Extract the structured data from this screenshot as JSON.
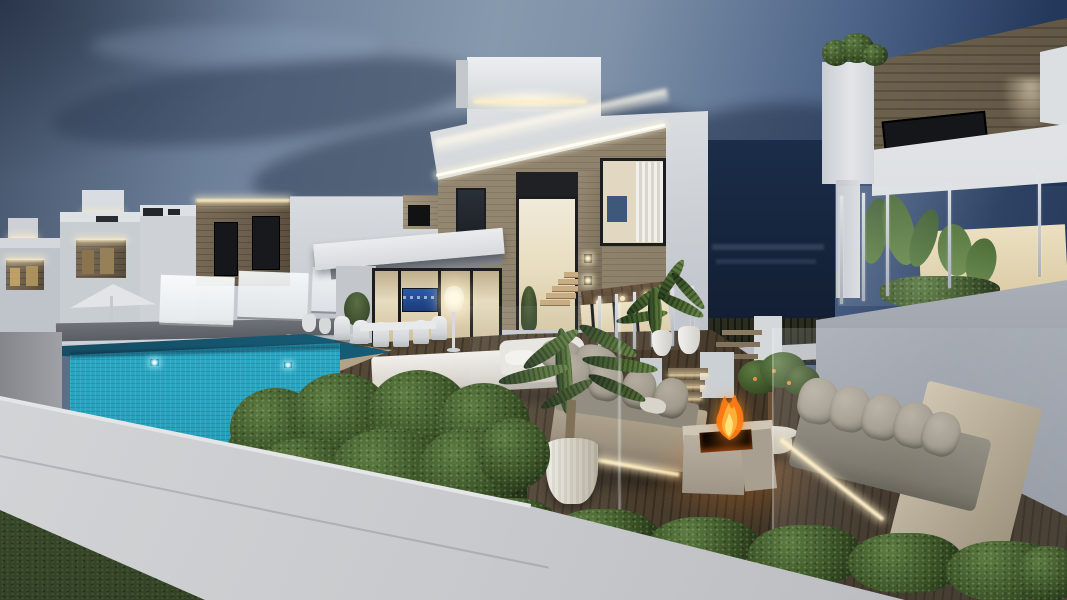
{
  "meta": {
    "title": "Modern luxury villas with glass-walled infinity pool at dusk — 3D architectural rendering",
    "type": "architectural visualization",
    "time_of_day": "dusk"
  },
  "scene": {
    "description": "Two-storey white modern villas with stone accent cladding and warm cove LED lighting, a glass-walled turquoise mosaic infinity pool, wooden deck terraces with grey outdoor lounge sofas, a burning square stone fire pit, potted palms, trimmed box hedges, frosted and clear glass balustrades, white boundary walls and a dark mountain backdrop under a blue evening sky.",
    "elements": [
      {
        "name": "sky",
        "desc": "dusk gradient sky with dark blue cloud streaks"
      },
      {
        "name": "background-villas",
        "desc": "row of white villas receding to the left with LED strips under parapets and warm lit stone recesses"
      },
      {
        "name": "main-villa",
        "desc": "two-storey white villa with stone band, tall staircase window, lit warm interiors and roof parapet with LED"
      },
      {
        "name": "right-villa",
        "desc": "villa with horizontal wood cladding band, downlight, glass balcony with banana plants"
      },
      {
        "name": "mountain",
        "desc": "dark hillside with faint distant buildings in the gap between villas"
      },
      {
        "name": "infinity-pool",
        "desc": "glass-walled pool with bright turquoise mosaic tile face and underwater lights"
      },
      {
        "name": "daybed",
        "desc": "white double sun lounger with grey back cushions at pool edge"
      },
      {
        "name": "dining-set",
        "desc": "white outdoor dining chairs and table on covered terrace"
      },
      {
        "name": "floor-lamp",
        "desc": "glowing white cone floor lamp"
      },
      {
        "name": "parasol",
        "desc": "white patio umbrella on left terrace"
      },
      {
        "name": "left-sofa",
        "desc": "outdoor sofa with grey cushions and warm LED underlighting"
      },
      {
        "name": "right-sofa",
        "desc": "long outdoor sofa seen through a glass screen"
      },
      {
        "name": "fire-pit",
        "desc": "square light stone fire pit with burning flames"
      },
      {
        "name": "side-table",
        "desc": "round white table with a small orange tree"
      },
      {
        "name": "palm-pot",
        "desc": "large potted palm on the lower deck"
      },
      {
        "name": "terrace-palms",
        "desc": "two potted palms on the upper terrace"
      },
      {
        "name": "hedge-front",
        "desc": "large trimmed hedge mass beside the pool"
      },
      {
        "name": "hedge-row",
        "desc": "low hedge row running along the lower boundary wall"
      },
      {
        "name": "foreground-wall",
        "desc": "white rendered boundary wall in the foreground"
      },
      {
        "name": "grass",
        "desc": "dark lawn in the bottom-left corner"
      },
      {
        "name": "steps",
        "desc": "wooden deck steps with LED strip lighting"
      },
      {
        "name": "glass-balustrades",
        "desc": "frosted and clear glass railings with metal posts"
      }
    ],
    "colors": {
      "sky_left": "#44536a",
      "sky_mid": "#8799ad",
      "sky_right": "#1a2c4c",
      "cloud": "#35465f",
      "villa_bright": "#eceef0",
      "villa_white": "#d5d8dc",
      "villa_shadow": "#b9bec5",
      "stone": "#93866f",
      "stone_dark": "#6a5d4b",
      "wood_clad": "#7a6e59",
      "led_warm": "#ffeec2",
      "window_frame": "#1b1d21",
      "interior_warm": "#e7dcbf",
      "tv_screen": "#2b5aa8",
      "pool_tile": "#2cacc8",
      "pool_deep": "#14485e",
      "deck_wood": "#554735",
      "deck_dark": "#3c3124",
      "tan_stone": "#ab9b80",
      "hedge": "#324a26",
      "hedge_light": "#5d7c42",
      "sofa_cushion": "#a09a8c",
      "sofa_base": "#b7aa93",
      "fire": "#ff7d12",
      "mountain": "#1b2d4a",
      "wall": "#c7c9cc",
      "grass": "#3f5130",
      "plant": "#4e6a36"
    }
  }
}
